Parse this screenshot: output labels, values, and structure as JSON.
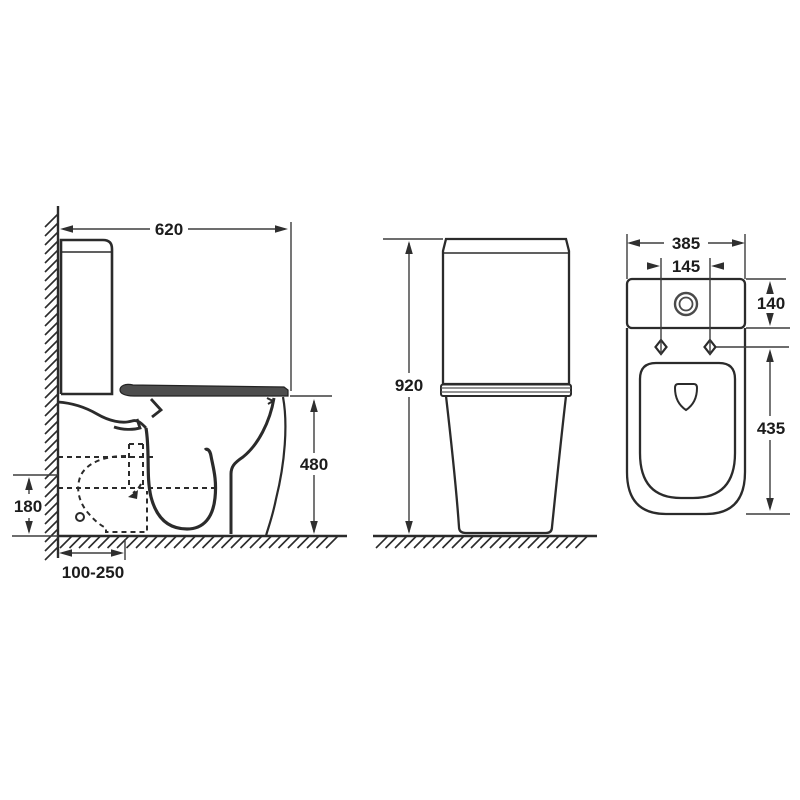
{
  "figure": {
    "kind": "toilet-dimension-drawing",
    "views": [
      "side-view",
      "front-view",
      "top-view"
    ]
  },
  "views": {
    "side": {
      "dims": {
        "overall_depth": "620",
        "seat_height": "480",
        "outlet_height": "180",
        "rough_in_range": "100-250"
      }
    },
    "front": {
      "dims": {
        "overall_height": "920"
      }
    },
    "top": {
      "dims": {
        "overall_width": "385",
        "fixing_centres": "145",
        "cistern_depth": "140",
        "pan_depth": "435"
      }
    }
  },
  "colors": {
    "background": "#ffffff",
    "line": "#2b2b2b",
    "dimension_line": "#3d3d3d",
    "seat_fill": "#4d4d4d",
    "arrow_fill": "#2f2f2f"
  }
}
